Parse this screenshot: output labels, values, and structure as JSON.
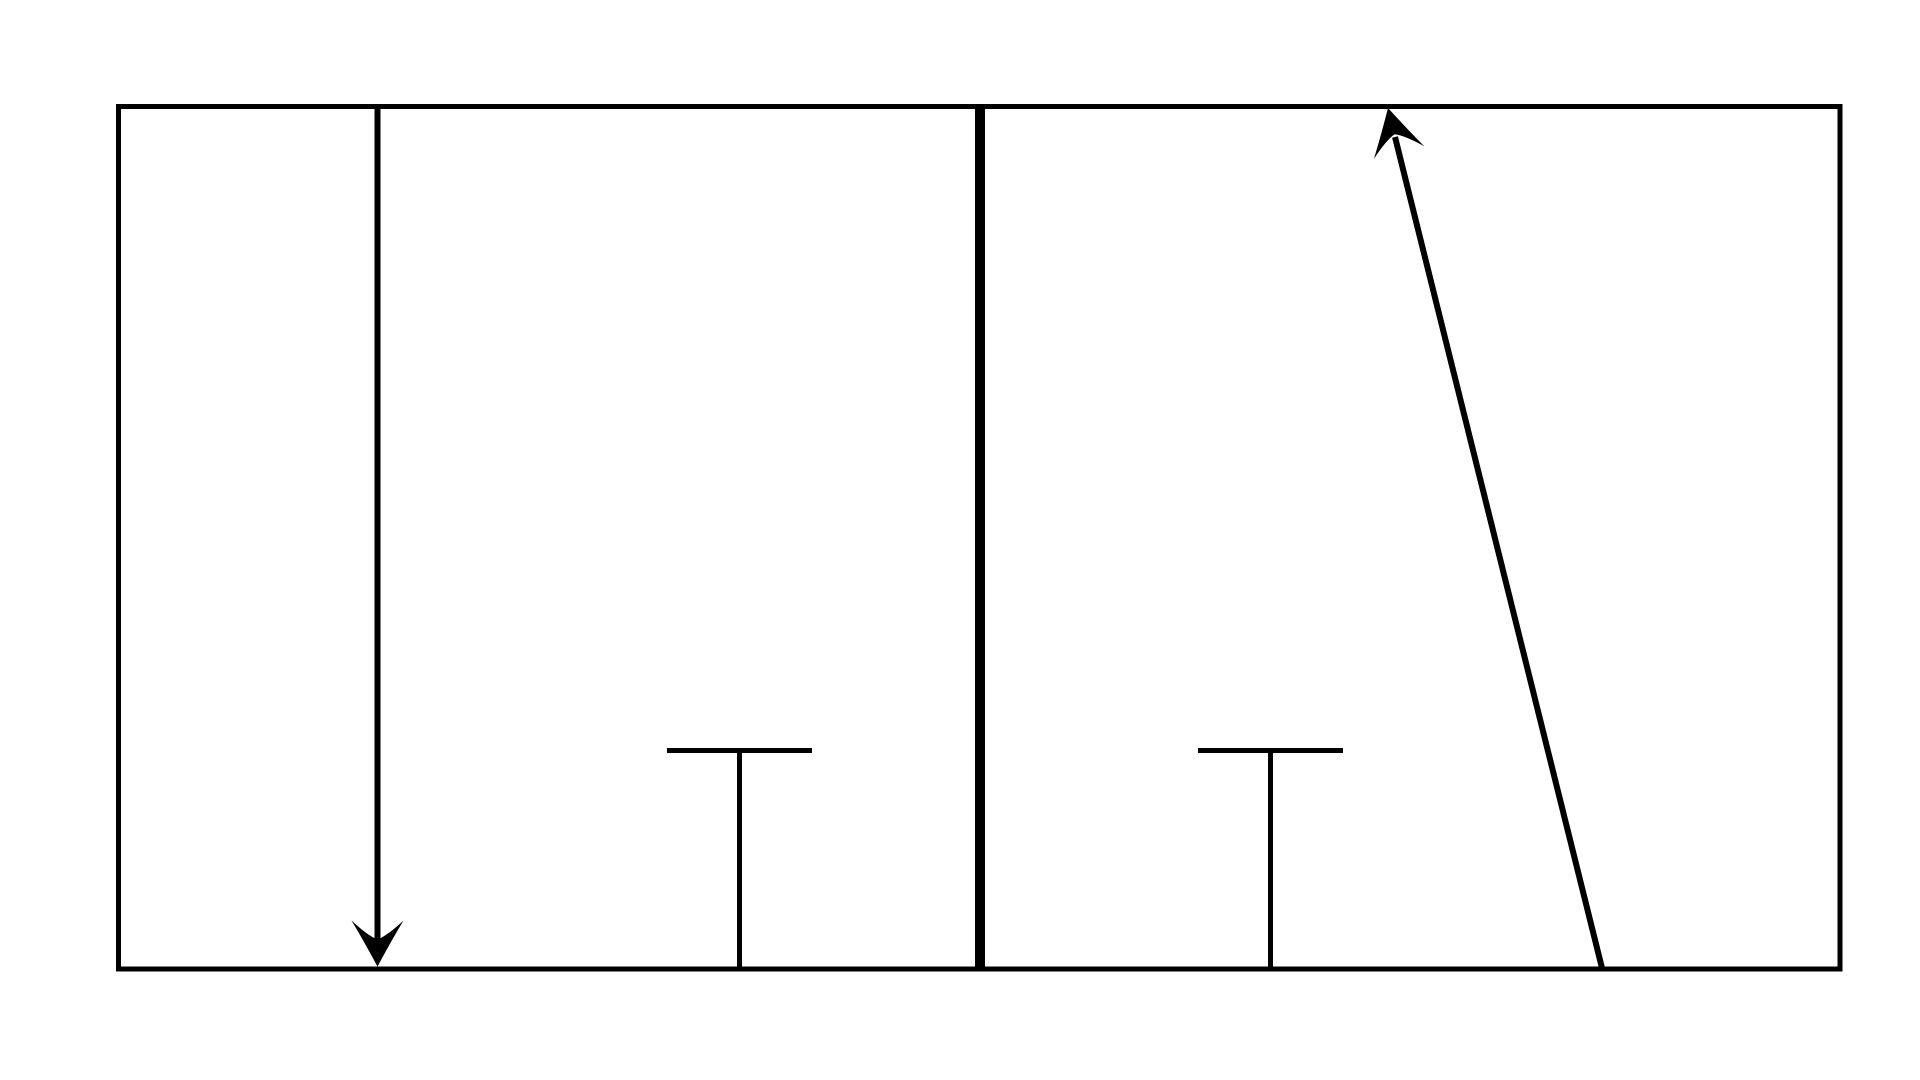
{
  "canvas": {
    "width": 1920,
    "height": 1080,
    "background": "#ffffff",
    "stroke_color": "#000000"
  },
  "frame": {
    "x": 118.5,
    "y": 106.5,
    "width": 1721.5,
    "height": 862.5,
    "stroke_width": 5
  },
  "divider": {
    "x": 980,
    "y1": 104,
    "y2": 971.5,
    "stroke_width": 10
  },
  "down_arrow": {
    "shaft": {
      "x": 377.5,
      "y1": 107,
      "y2": 945,
      "stroke_width": 6
    },
    "head": {
      "tip_x": 377.5,
      "tip_y": 966.5,
      "rotate": 0,
      "path": "M 0 0 Q -14 -26 -26 -46 Q -10 -31 0 -27 Q 10 -31 26 -46 Q 14 -26 0 0 Z"
    }
  },
  "left_tee": {
    "bar": {
      "x1": 667,
      "x2": 812,
      "y": 750.5,
      "stroke_width": 5
    },
    "stem": {
      "x": 739.5,
      "y1": 750.5,
      "y2": 969,
      "stroke_width": 5
    }
  },
  "right_tee": {
    "bar": {
      "x1": 1198,
      "x2": 1343,
      "y": 750.5,
      "stroke_width": 5
    },
    "stem": {
      "x": 1270.5,
      "y1": 750.5,
      "y2": 969,
      "stroke_width": 5
    }
  },
  "diagonal_arrow": {
    "shaft": {
      "x1": 1602,
      "y1": 968,
      "x2": 1395,
      "y2": 137,
      "stroke_width": 6
    },
    "head": {
      "tip_x": 1388,
      "tip_y": 108,
      "rotate": -14,
      "path": "M 0 0 Q -14 26 -26 46 Q -10 31 0 27 Q 10 31 26 46 Q 14 26 0 0 Z"
    }
  }
}
